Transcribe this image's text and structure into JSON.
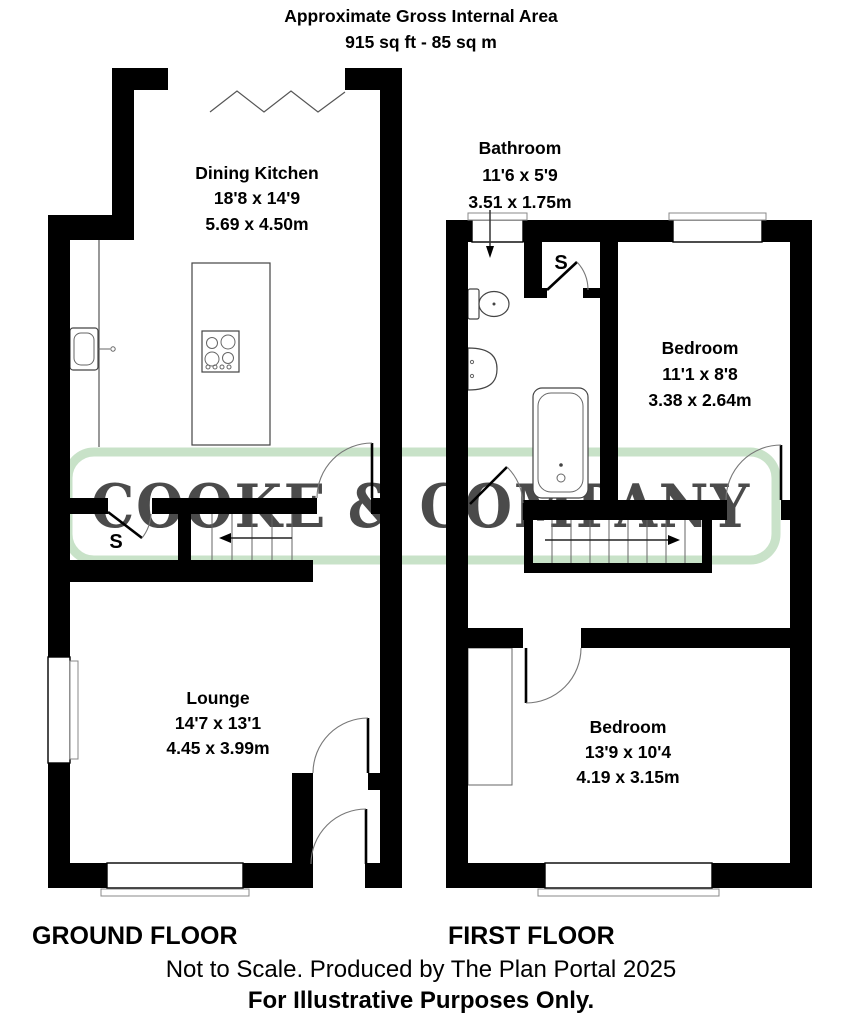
{
  "title": {
    "line1": "Approximate Gross Internal Area",
    "line2": "915 sq ft - 85 sq m"
  },
  "watermark": {
    "text": "COOKE & COMPANY",
    "color": "#b2d6b2"
  },
  "ground_floor": {
    "label": "GROUND FLOOR",
    "storage_label": "S",
    "rooms": [
      {
        "name": "Dining Kitchen",
        "imperial": "18'8 x 14'9",
        "metric": "5.69 x 4.50m"
      },
      {
        "name": "Lounge",
        "imperial": "14'7 x 13'1",
        "metric": "4.45 x 3.99m"
      }
    ]
  },
  "first_floor": {
    "label": "FIRST FLOOR",
    "storage_label": "S",
    "rooms": [
      {
        "name": "Bathroom",
        "imperial": "11'6 x 5'9",
        "metric": "3.51 x 1.75m"
      },
      {
        "name": "Bedroom",
        "imperial": "11'1 x 8'8",
        "metric": "3.38 x 2.64m"
      },
      {
        "name": "Bedroom",
        "imperial": "13'9 x 10'4",
        "metric": "4.19 x 3.15m"
      }
    ]
  },
  "footer": {
    "line1": "Not to Scale. Produced by The Plan Portal 2025",
    "line2": "For Illustrative Purposes Only."
  }
}
